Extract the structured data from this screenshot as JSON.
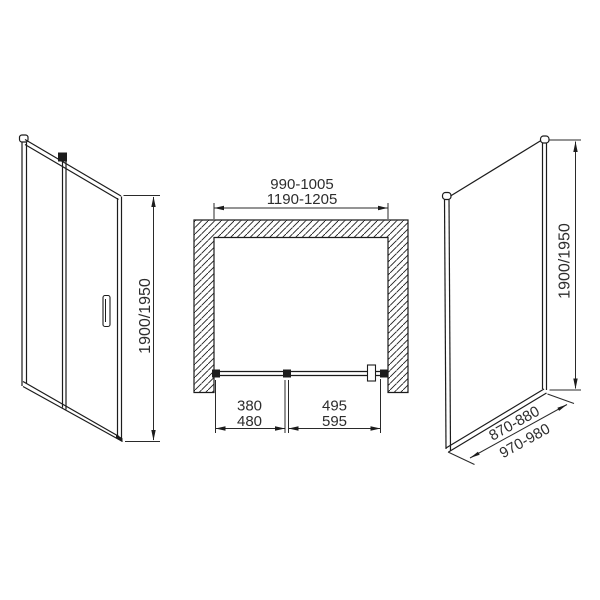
{
  "drawing": {
    "kind": "shower-enclosure-technical-drawing",
    "colors": {
      "background": "#ffffff",
      "line": "#1c1c1c",
      "text": "#2d2d2d"
    },
    "front_view": {
      "description": "front elevation of sliding door with fixed panel and handle",
      "height_dim": "1900/1950"
    },
    "plan_view": {
      "description": "top plan view of recess installation with hatched walls",
      "opening_width_small": "990-1005",
      "opening_width_large": "1190-1205",
      "fixed_panel_width_small": "380",
      "fixed_panel_width_large": "480",
      "door_panel_width_small": "495",
      "door_panel_width_large": "595"
    },
    "side_view": {
      "description": "side fixed panel in oblique projection",
      "height_dim": "1900/1950",
      "panel_width_small": "870-880",
      "panel_width_large": "970-980"
    }
  }
}
